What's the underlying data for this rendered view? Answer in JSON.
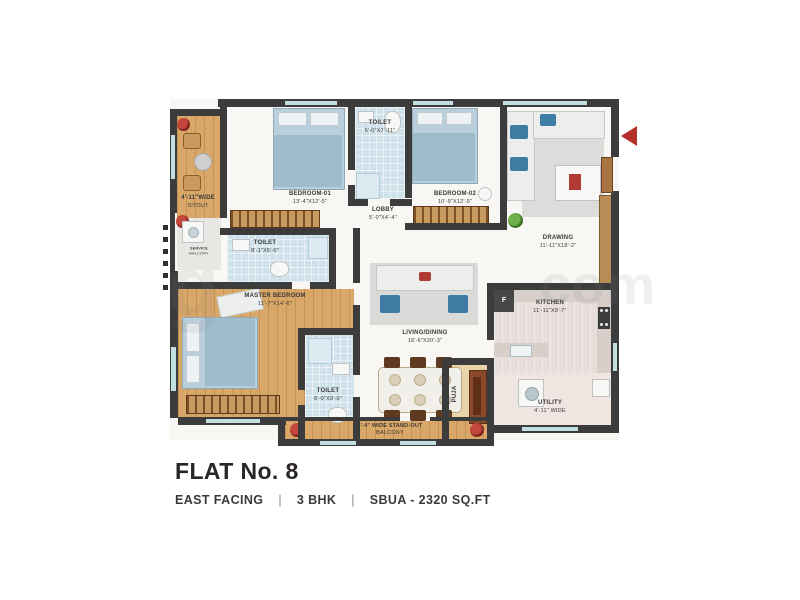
{
  "title_block": {
    "title": "FLAT No. 8",
    "facing": "EAST FACING",
    "bhk": "3 BHK",
    "sbua": "SBUA - 2320 SQ.FT",
    "separator": "|"
  },
  "plan": {
    "rooms": {
      "sitout": {
        "line1": "4'-11\"WIDE",
        "line2": "SITOUT"
      },
      "bedroom1": {
        "line1": "BEDROOM-01",
        "line2": "13'-4\"X12'-5\""
      },
      "toilet_top": {
        "line1": "TOILET",
        "line2": "5'-0\"X7'-11\""
      },
      "lobby": {
        "line1": "LOBBY",
        "line2": "5'-0\"X4'-4\""
      },
      "bedroom2": {
        "line1": "BEDROOM-02",
        "line2": "10'-9\"X12'-5\""
      },
      "drawing": {
        "line1": "DRAWING",
        "line2": "11'-11\"X18'-2\""
      },
      "service_balcony": {
        "line1": "SERVICE",
        "line2": "BALCONY"
      },
      "toilet_mid": {
        "line1": "TOILET",
        "line2": "8'-1\"X5'-0\""
      },
      "master_bedroom": {
        "line1": "MASTER BEDROOM",
        "line2": "11'-7\"X14'-6\""
      },
      "toilet_bottom": {
        "line1": "TOILET",
        "line2": "6'-0\"X9'-0\""
      },
      "living_dining": {
        "line1": "LIVING/DINING",
        "line2": "16'-6\"X20'-3\""
      },
      "kitchen": {
        "line1": "KITCHEN",
        "line2": "11'-11\"X9'-7\""
      },
      "puja": {
        "line1": "PUJA",
        "line2": ""
      },
      "utility": {
        "line1": "UTILITY",
        "line2": "4'-11\" WIDE"
      },
      "balcony": {
        "line1": "2'-4\" WIDE STAND-OUT",
        "line2": "BALCONY"
      }
    },
    "fridge_label": "F",
    "entry_arrow_color": "#b23028",
    "wall_color": "#3c3c3c",
    "window_color": "#c2e0e2",
    "wood_color": "#d9a767",
    "tile_color": "#cfe1ea"
  },
  "watermark": {
    "fragments": [
      "g",
      "com"
    ]
  }
}
